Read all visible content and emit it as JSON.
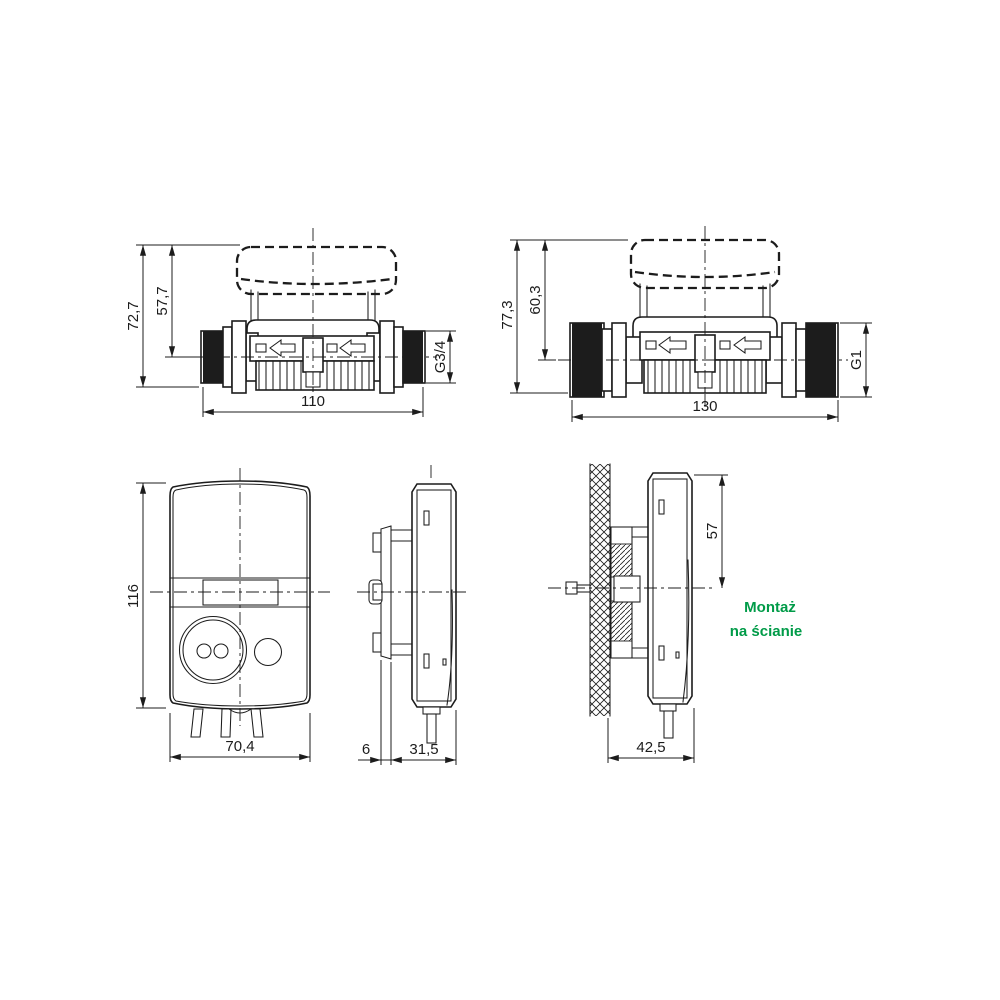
{
  "colors": {
    "line": "#1c1c1c",
    "background": "#ffffff",
    "note_green": "#009b48"
  },
  "meter_g34": {
    "height_total": "72,7",
    "height_to_center": "57,7",
    "length": "110",
    "thread": "G3/4"
  },
  "meter_g1": {
    "height_total": "77,3",
    "height_to_center": "60,3",
    "length": "130",
    "thread": "G1"
  },
  "display_front": {
    "height": "116",
    "width": "70,4"
  },
  "display_side": {
    "bracket_offset": "6",
    "depth": "31,5"
  },
  "wall_mount": {
    "top_to_center": "57",
    "depth_from_wall": "42,5",
    "note_line1": "Montaż",
    "note_line2": "na ścianie"
  }
}
